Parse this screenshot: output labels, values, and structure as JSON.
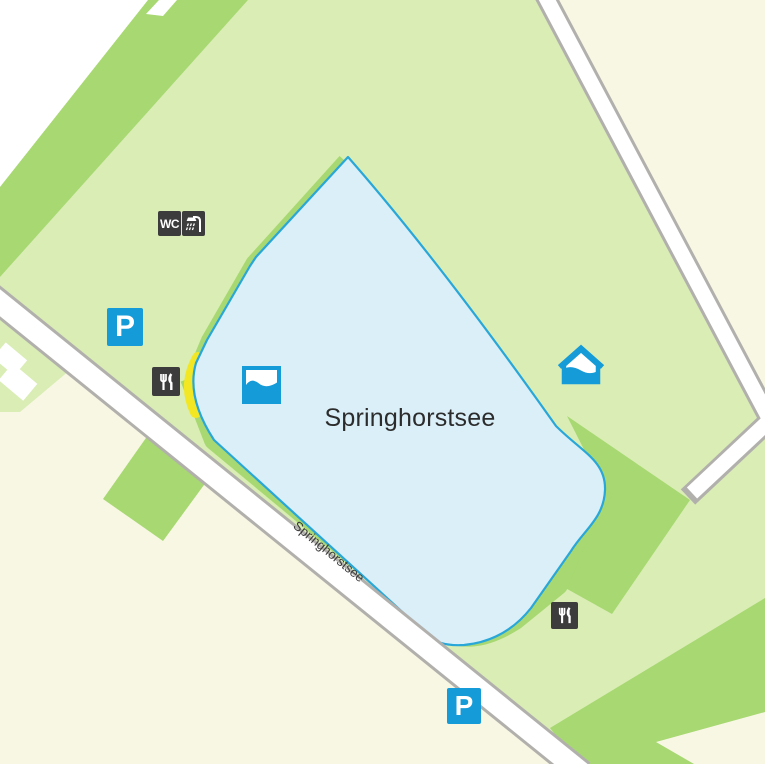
{
  "title": "Springhorstsee area map",
  "lake": {
    "label": "Springhorstsee"
  },
  "road": {
    "label": "Springhorstsee"
  },
  "markers": {
    "wc": {
      "label": "WC",
      "meaning": "toilets"
    },
    "shower": {
      "meaning": "showers"
    },
    "parking_north": {
      "label": "P",
      "meaning": "parking"
    },
    "parking_south": {
      "label": "P",
      "meaning": "parking"
    },
    "restaurant_west": {
      "meaning": "restaurant"
    },
    "restaurant_south": {
      "meaning": "restaurant"
    },
    "bathing_area": {
      "meaning": "open-air bathing water"
    },
    "bath_house": {
      "meaning": "bath house / indoor swimming"
    }
  },
  "colors": {
    "background": "#f8f7e4",
    "forest_light": "#d9edb5",
    "forest_medium": "#a7d871",
    "unmapped_white": "#ffffff",
    "water_fill": "#dbeff9",
    "water_stroke": "#28a7d8",
    "road_fill": "#ffffff",
    "road_casing": "#b2b0ac",
    "beach_yellow": "#f2e722",
    "marker_dark": "#3d3c3c",
    "marker_blue": "#149bd8",
    "label_color": "#2c2c2c"
  }
}
